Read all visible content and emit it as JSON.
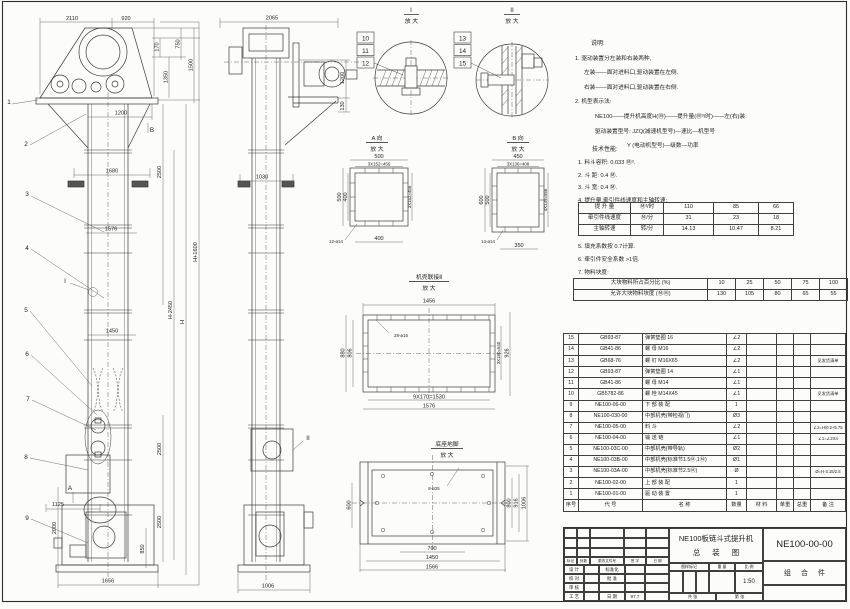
{
  "doc": {
    "type": "assembly-drawing"
  },
  "notes": {
    "title": "说明:",
    "l1": "1. 驱动装置分左装和右装两种,",
    "l2": "左装——面对进料口,驱动装置在左侧.",
    "l3": "右装——面对进料口,驱动装置在右侧.",
    "l4": "2. 机型表示法:",
    "l5": "NE100——提升机高度H(Ⓜ)——提升量(Ⓜ³/时)——左(右)装.",
    "l6": "驱动装置型号: JZQ(减速机型号)—速比—机型号",
    "l7": "Y (电动机型号)—级数—功率"
  },
  "perf": {
    "title": "技术性能:",
    "i1": "1. 料斗容积: 0.033 Ⓜ³.",
    "i2": "2. 斗  距: 0.4 Ⓜ.",
    "i3": "3. 斗  宽: 0.4 Ⓜ.",
    "i4": "4. 提升量,牵引件线速度和主轴转速:",
    "i5": "5. 填充系数按 0.7计算.",
    "i6": "6. 牵引件安全系数 >1倍.",
    "i7": "7. 物料块度:"
  },
  "chart_data": [
    {
      "type": "table",
      "title": "提升量,牵引件线速度和主轴转速",
      "rows": [
        {
          "label": "提 升 量",
          "unit": "Ⓜ³/时",
          "values": [
            "110",
            "85",
            "66"
          ]
        },
        {
          "label": "牵引件线速度",
          "unit": "Ⓜ/分",
          "values": [
            "31",
            "23",
            "18"
          ]
        },
        {
          "label": "主轴转速",
          "unit": "转/分",
          "values": [
            "14.13",
            "10.47",
            "8.21"
          ]
        }
      ]
    },
    {
      "type": "table",
      "title": "物料块度",
      "rows": [
        {
          "label": "大块物料所占百分比 (%)",
          "values": [
            "10",
            "25",
            "50",
            "75",
            "100"
          ]
        },
        {
          "label": "允许大块物料块度 (ⓂⓂ)",
          "values": [
            "130",
            "105",
            "80",
            "65",
            "55"
          ]
        }
      ]
    }
  ],
  "speed": {
    "r1l": "提 升 量",
    "r1u": "Ⓜ³/时",
    "r1a": "110",
    "r1b": "85",
    "r1c": "66",
    "r2l": "牵引件线速度",
    "r2u": "Ⓜ/分",
    "r2a": "31",
    "r2b": "23",
    "r2c": "18",
    "r3l": "主轴转速",
    "r3u": "转/分",
    "r3a": "14.13",
    "r3b": "10.47",
    "r3c": "8.21"
  },
  "lump": {
    "r1l": "大块物料所占百分比 (%)",
    "r1a": "10",
    "r1b": "25",
    "r1c": "50",
    "r1d": "75",
    "r1e": "100",
    "r2l": "允许大块物料块度 (ⓂⓂ)",
    "r2a": "130",
    "r2b": "105",
    "r2c": "80",
    "r2d": "65",
    "r2e": "55"
  },
  "bom": {
    "hdr": {
      "no": "序号",
      "code": "代  号",
      "name": "名  称",
      "qty": "数量",
      "mat": "材  料",
      "uw": "单重",
      "tw": "总重",
      "rk": "备 注"
    },
    "rows": [
      {
        "no": "15",
        "code": "GB93-87",
        "name": "弹簧垫圈  16",
        "qty": "∠2",
        "rk": ""
      },
      {
        "no": "14",
        "code": "GB41-86",
        "name": "螺 母  M16",
        "qty": "∠2",
        "rk": ""
      },
      {
        "no": "13",
        "code": "GB68-76",
        "name": "螺 钉  M16X65",
        "qty": "∠2",
        "rk": "见发货清单"
      },
      {
        "no": "12",
        "code": "GB93-87",
        "name": "弹簧垫圈  14",
        "qty": "∠1",
        "rk": ""
      },
      {
        "no": "11",
        "code": "GB41-86",
        "name": "螺 母  M14",
        "qty": "∠1",
        "rk": ""
      },
      {
        "no": "10",
        "code": "GB5782-86",
        "name": "螺 栓  M14X45",
        "qty": "∠1",
        "rk": "见发货清单"
      },
      {
        "no": "9",
        "code": "NE100-06-00",
        "name": "下 部 装 配",
        "qty": "1",
        "rk": ""
      },
      {
        "no": "8",
        "code": "NE100-030-00",
        "name": "中部机壳(带检视门)",
        "qty": "Ø3",
        "rk": ""
      },
      {
        "no": "7",
        "code": "NE100-05-00",
        "name": "料  斗",
        "qty": "∠2",
        "rk": "∠2=H/0.2+5.75"
      },
      {
        "no": "6",
        "code": "NE100-04-00",
        "name": "输 送 链",
        "qty": "∠1",
        "rk": "∠1=∠2X4"
      },
      {
        "no": "5",
        "code": "NE100-03C-00",
        "name": "中部机壳(带导轨)",
        "qty": "Ø2",
        "rk": ""
      },
      {
        "no": "4",
        "code": "NE100-03B-00",
        "name": "中部机壳(标准节1.5Ⓜ,1Ⓜ)",
        "qty": "Ø1",
        "rk": ""
      },
      {
        "no": "3",
        "code": "NE100-03A-00",
        "name": "中部机壳(标准节2.5Ⓜ)",
        "qty": "Ø",
        "rk": "Ø=H-3.15/2.5"
      },
      {
        "no": "2",
        "code": "NE100-02-00",
        "name": "上 部 装 配",
        "qty": "1",
        "rk": ""
      },
      {
        "no": "1",
        "code": "NE100-01-00",
        "name": "驱 动 装 置",
        "qty": "1",
        "rk": ""
      }
    ]
  },
  "tb": {
    "title1": "NE100板链斗式提升机",
    "title2": "总  装  图",
    "dwgno": "NE100-00-00",
    "kind": "组 合 件",
    "rh1": "标记",
    "rh2": "处数",
    "rh3": "更改文件号",
    "rh4": "签 字",
    "rh5": "日 期",
    "r1a": "设 计",
    "r1b": "标准化",
    "r2a": "校 对",
    "r2b": "批 准",
    "r3a": "审 核",
    "r4a": "工 艺",
    "r4b": "日 期",
    "date": "97.7",
    "m1": "图样标记",
    "m2": "重 量",
    "m3": "比 例",
    "scale": "1:50",
    "s1": "共    张",
    "s2": "第    张"
  },
  "fv": {
    "c1": "1",
    "c2": "2",
    "c3": "3",
    "c4": "4",
    "c5": "5",
    "c6": "6",
    "c7": "7",
    "c8": "8",
    "c9": "9",
    "d2110": "2110",
    "d920": "920",
    "d170": "170",
    "d750": "750",
    "d1350": "1350",
    "d1500": "1500",
    "d1200": "1200",
    "mB": "B",
    "d1680": "1680",
    "d1576": "1576",
    "d2500": "2500",
    "dH2450": "H-2450",
    "dH": "H",
    "dH1600": "H+1600",
    "mI": "I",
    "d1450": "1450",
    "mA": "A",
    "d1125": "1125",
    "d2000": "2000",
    "d850": "850",
    "d1656": "1656"
  },
  "sv": {
    "d2065": "2065",
    "d1200": "1200",
    "d130": "130",
    "d1030": "1030",
    "d1006": "1006",
    "mII": "II"
  },
  "di": {
    "t": "I",
    "sub": "放 大",
    "c10": "10",
    "c11": "11",
    "c12": "12"
  },
  "dii": {
    "t": "II",
    "sub": "放 大",
    "c13": "13",
    "c14": "14",
    "c15": "15"
  },
  "va": {
    "t": "A 向",
    "sub": "放 大",
    "d500t": "500",
    "drow": "3X152=456",
    "d500l": "500",
    "d400l": "400",
    "dr": "3X152=456",
    "dh": "12-ø14",
    "d400b": "400"
  },
  "vb": {
    "t": "B 向",
    "sub": "放 大",
    "d450": "450",
    "drow": "3X136=408",
    "d600": "600",
    "d500": "500",
    "dr": "4X139=556",
    "dh": "14-ø14",
    "d350": "350"
  },
  "cj": {
    "t": "机壳联接Ⅱ",
    "sub": "放 大",
    "d1456": "1456",
    "dh": "28-ø16",
    "d880": "880",
    "d806": "806",
    "dr1": "3X180=540",
    "dr2": "926",
    "db1": "9X170=1530",
    "db2": "1576"
  },
  "bv": {
    "t": "底座地脚",
    "sub": "放 大",
    "dh": "8-ø25",
    "d600": "600",
    "d800": "800",
    "d916": "916",
    "d1006": "1006",
    "d700": "700",
    "d1450": "1450",
    "d1566": "1566"
  }
}
